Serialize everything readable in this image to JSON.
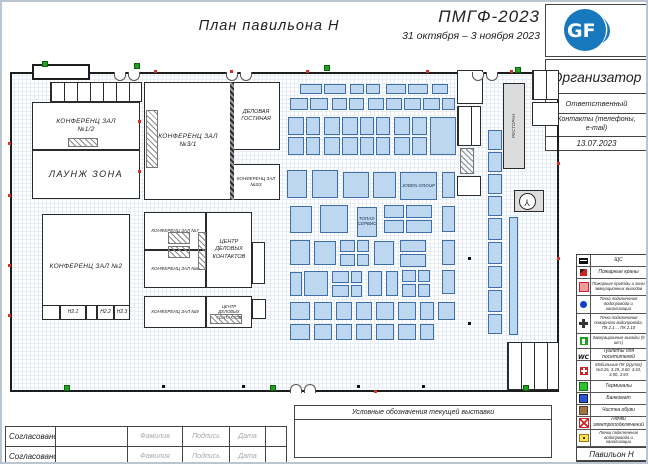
{
  "header": {
    "plan_title": "План павильона Н",
    "event_title": "ПМГФ-2023",
    "event_dates": "31 октября – 3 ноября 2023"
  },
  "logo": {
    "text": "GF",
    "color": "#1878be"
  },
  "org": {
    "organizer": "Организатор",
    "responsible": "Ответственный",
    "contacts": "Контакты (телефоны,\ne-mail)",
    "date": "13.07.2023"
  },
  "expo_box": {
    "title": "Условные обозначения текущей выставки"
  },
  "approval": {
    "rows": [
      {
        "label": "Согласовано",
        "surname": "Фамилия",
        "signature": "Подпись",
        "date": "Дата"
      },
      {
        "label": "Согласовано",
        "surname": "Фамилия",
        "signature": "Подпись",
        "date": "Дата"
      }
    ]
  },
  "legend": {
    "footer": "Павильон Н",
    "items": [
      {
        "icon": "panel",
        "h": 11,
        "label": "ЩС"
      },
      {
        "icon": "hydrant",
        "h": 11,
        "label": "Пожарные краны"
      },
      {
        "icon": "zone",
        "h": 16,
        "label": "Пожарные проезды и зоны эвакуационных выходов"
      },
      {
        "icon": "water",
        "h": 17,
        "label": "Точка подключения водопровода и канализации"
      },
      {
        "icon": "firewater",
        "h": 19,
        "label": "Точка подключения пожарного водопровода, ПК 2.1 ... ПК 2.10"
      },
      {
        "icon": "exit",
        "h": 14,
        "label": "Эвакуационные выходы (9 шт.)"
      },
      {
        "icon": "wc",
        "h": 11,
        "label": "Туалеты для посетителей"
      },
      {
        "icon": "mobilepk",
        "h": 19,
        "label": "Мобильные ПК (группа) №3.26, 3.29, 3.60, 3.63, 3.90, 3.93"
      },
      {
        "icon": "terminal",
        "h": 11,
        "label": "Терминалы"
      },
      {
        "icon": "atm",
        "h": 11,
        "label": "Банкомат"
      },
      {
        "icon": "shoe",
        "h": 11,
        "label": "Чистка обуви"
      },
      {
        "icon": "hatch-el",
        "h": 12,
        "label": "Лючки электроподключений"
      },
      {
        "icon": "hatch-wat",
        "h": 16,
        "label": "Лючки подключения водопровода и канализации"
      },
      {
        "icon": "air",
        "h": 14,
        "label": "Точки подключения сжатого воздуха"
      }
    ]
  },
  "plan": {
    "colors": {
      "booth_fill": "#bdd7f0",
      "booth_border": "#3f6fa5",
      "wall": "#1d1d1d",
      "exit_green": "#21a121",
      "fire_red": "#d43322",
      "logo_blue": "#1878be"
    },
    "rooms": [
      {
        "r": [
          8,
          70,
          549,
          320
        ],
        "label": "",
        "cls": "outer"
      },
      {
        "r": [
          30,
          62,
          58,
          16
        ],
        "label": "",
        "cls": "outer2"
      },
      {
        "r": [
          48,
          80,
          92,
          20
        ],
        "label": "",
        "cls": "cellsH"
      },
      {
        "r": [
          30,
          100,
          108,
          48
        ],
        "label": "КОНФЕРЕНЦ ЗАЛ\n№1/2",
        "cls": "lg"
      },
      {
        "r": [
          66,
          136,
          30,
          9
        ],
        "label": "",
        "cls": "hatch"
      },
      {
        "r": [
          30,
          148,
          108,
          49
        ],
        "label": "ЛАУНЖ ЗОНА",
        "cls": "xl"
      },
      {
        "r": [
          40,
          212,
          88,
          106
        ],
        "label": "КОНФЕРЕНЦ ЗАЛ №2",
        "cls": "lg"
      },
      {
        "r": [
          40,
          303,
          18,
          15
        ],
        "label": "",
        "cls": ""
      },
      {
        "r": [
          58,
          303,
          26,
          15
        ],
        "label": "Н2.1",
        "cls": "sm"
      },
      {
        "r": [
          84,
          303,
          11,
          15
        ],
        "label": "",
        "cls": ""
      },
      {
        "r": [
          95,
          303,
          17,
          15
        ],
        "label": "Н2.2",
        "cls": "sm"
      },
      {
        "r": [
          112,
          303,
          16,
          15
        ],
        "label": "Н2.3",
        "cls": "sm"
      },
      {
        "r": [
          142,
          80,
          88,
          118
        ],
        "label": "КОНФЕРЕНЦ ЗАЛ\n№3/1",
        "cls": "lg"
      },
      {
        "r": [
          144,
          108,
          12,
          58
        ],
        "label": "",
        "cls": "hatch"
      },
      {
        "r": [
          228,
          80,
          4,
          118
        ],
        "label": "",
        "cls": "wallT"
      },
      {
        "r": [
          230,
          80,
          48,
          68
        ],
        "label": "ДЕЛОВАЯ\nГОСТИНАЯ",
        "cls": "md"
      },
      {
        "r": [
          230,
          162,
          48,
          36
        ],
        "label": "КОНФЕРЕНЦ ЗАЛ\n№3/3",
        "cls": "xs"
      },
      {
        "r": [
          142,
          210,
          62,
          38
        ],
        "label": "КОНФЕРЕНЦ ЗАЛ №7",
        "cls": "xs"
      },
      {
        "r": [
          142,
          248,
          62,
          38
        ],
        "label": "КОНФЕРЕНЦ ЗАЛ №8",
        "cls": "xs"
      },
      {
        "r": [
          204,
          210,
          46,
          76
        ],
        "label": "ЦЕНТР\nДЕЛОВЫХ\nКОНТАКТОВ",
        "cls": "md"
      },
      {
        "r": [
          166,
          230,
          22,
          12
        ],
        "label": "",
        "cls": "hatch"
      },
      {
        "r": [
          166,
          244,
          22,
          12
        ],
        "label": "",
        "cls": "hatch"
      },
      {
        "r": [
          196,
          230,
          8,
          38
        ],
        "label": "",
        "cls": "hatch"
      },
      {
        "r": [
          250,
          240,
          13,
          42
        ],
        "label": "",
        "cls": ""
      },
      {
        "r": [
          142,
          294,
          62,
          32
        ],
        "label": "КОНФЕРЕНЦ ЗАЛ №9",
        "cls": "xs"
      },
      {
        "r": [
          204,
          294,
          46,
          32
        ],
        "label": "ЦЕНТР\nДЕЛОВЫХ\nКОНТАКТОВ",
        "cls": "xs2"
      },
      {
        "r": [
          208,
          312,
          32,
          10
        ],
        "label": "",
        "cls": "hatch"
      },
      {
        "r": [
          250,
          297,
          14,
          20
        ],
        "label": "",
        "cls": ""
      },
      {
        "r": [
          455,
          68,
          26,
          34
        ],
        "label": "",
        "cls": ""
      },
      {
        "r": [
          455,
          104,
          24,
          40
        ],
        "label": "",
        "cls": "cellsH"
      },
      {
        "r": [
          458,
          146,
          14,
          26
        ],
        "label": "",
        "cls": "hatch"
      },
      {
        "r": [
          455,
          174,
          24,
          20
        ],
        "label": "",
        "cls": ""
      },
      {
        "r": [
          501,
          81,
          22,
          86
        ],
        "label": "РЕСТОРАН",
        "cls": "grey vert"
      },
      {
        "r": [
          512,
          188,
          30,
          22
        ],
        "label": "",
        "cls": "grey"
      },
      {
        "r": [
          517,
          191,
          17,
          17
        ],
        "label": "Y",
        "cls": "fan"
      },
      {
        "r": [
          530,
          68,
          27,
          30
        ],
        "label": "",
        "cls": "cellsH"
      },
      {
        "r": [
          530,
          100,
          27,
          24
        ],
        "label": "",
        "cls": ""
      },
      {
        "r": [
          505,
          340,
          52,
          48
        ],
        "label": "",
        "cls": "cellsH"
      }
    ],
    "booths": [
      [
        298,
        82,
        22,
        10
      ],
      [
        322,
        82,
        22,
        10
      ],
      [
        348,
        82,
        14,
        10
      ],
      [
        364,
        82,
        14,
        10
      ],
      [
        384,
        82,
        20,
        10
      ],
      [
        406,
        82,
        20,
        10
      ],
      [
        430,
        82,
        16,
        10
      ],
      [
        288,
        96,
        18,
        12
      ],
      [
        308,
        96,
        18,
        12
      ],
      [
        330,
        96,
        15,
        12
      ],
      [
        347,
        96,
        15,
        12
      ],
      [
        366,
        96,
        16,
        12
      ],
      [
        384,
        96,
        16,
        12
      ],
      [
        402,
        96,
        17,
        12
      ],
      [
        421,
        96,
        17,
        12
      ],
      [
        440,
        96,
        13,
        12
      ],
      [
        286,
        115,
        16,
        18
      ],
      [
        304,
        115,
        14,
        18
      ],
      [
        322,
        115,
        16,
        18
      ],
      [
        340,
        115,
        16,
        18
      ],
      [
        358,
        115,
        14,
        18
      ],
      [
        374,
        115,
        14,
        18
      ],
      [
        392,
        115,
        16,
        18
      ],
      [
        410,
        115,
        15,
        18
      ],
      [
        428,
        115,
        26,
        38
      ],
      [
        286,
        135,
        16,
        18
      ],
      [
        304,
        135,
        14,
        18
      ],
      [
        322,
        135,
        16,
        18
      ],
      [
        340,
        135,
        16,
        18
      ],
      [
        358,
        135,
        14,
        18
      ],
      [
        374,
        135,
        14,
        18
      ],
      [
        392,
        135,
        16,
        18
      ],
      [
        410,
        135,
        15,
        18
      ],
      [
        285,
        168,
        20,
        28
      ],
      [
        310,
        168,
        26,
        28
      ],
      [
        341,
        170,
        26,
        26
      ],
      [
        371,
        170,
        23,
        26
      ],
      [
        398,
        170,
        37,
        28,
        "JODEN GROUP"
      ],
      [
        440,
        170,
        13,
        26
      ],
      [
        288,
        204,
        22,
        27
      ],
      [
        318,
        203,
        28,
        28
      ],
      [
        355,
        205,
        20,
        30,
        "ТОПАЗ-\nСЕРВИС"
      ],
      [
        382,
        203,
        20,
        13
      ],
      [
        404,
        203,
        26,
        13
      ],
      [
        382,
        218,
        20,
        13
      ],
      [
        404,
        218,
        26,
        13
      ],
      [
        440,
        204,
        13,
        26
      ],
      [
        288,
        238,
        20,
        25
      ],
      [
        312,
        239,
        22,
        24
      ],
      [
        338,
        238,
        15,
        12
      ],
      [
        355,
        238,
        12,
        12
      ],
      [
        338,
        252,
        15,
        12
      ],
      [
        355,
        252,
        12,
        12
      ],
      [
        372,
        239,
        20,
        24
      ],
      [
        398,
        238,
        26,
        12
      ],
      [
        398,
        252,
        26,
        13
      ],
      [
        440,
        238,
        13,
        25
      ],
      [
        288,
        270,
        12,
        24
      ],
      [
        302,
        269,
        24,
        25
      ],
      [
        330,
        269,
        17,
        12
      ],
      [
        349,
        269,
        11,
        12
      ],
      [
        330,
        283,
        17,
        12
      ],
      [
        349,
        283,
        11,
        12
      ],
      [
        366,
        269,
        14,
        25
      ],
      [
        384,
        269,
        12,
        25
      ],
      [
        400,
        268,
        14,
        12
      ],
      [
        416,
        268,
        12,
        12
      ],
      [
        400,
        282,
        14,
        13
      ],
      [
        416,
        282,
        12,
        13
      ],
      [
        440,
        268,
        13,
        24
      ],
      [
        288,
        300,
        20,
        18
      ],
      [
        312,
        300,
        18,
        18
      ],
      [
        334,
        300,
        16,
        18
      ],
      [
        354,
        300,
        16,
        18
      ],
      [
        374,
        300,
        18,
        18
      ],
      [
        396,
        300,
        18,
        18
      ],
      [
        418,
        300,
        14,
        18
      ],
      [
        436,
        300,
        17,
        18
      ],
      [
        288,
        322,
        20,
        16
      ],
      [
        312,
        322,
        18,
        16
      ],
      [
        334,
        322,
        16,
        16
      ],
      [
        354,
        322,
        16,
        16
      ],
      [
        374,
        322,
        18,
        16
      ],
      [
        396,
        322,
        18,
        16
      ],
      [
        418,
        322,
        14,
        16
      ],
      [
        486,
        128,
        14,
        20
      ],
      [
        486,
        150,
        14,
        20
      ],
      [
        486,
        172,
        14,
        20
      ],
      [
        486,
        194,
        14,
        20
      ],
      [
        486,
        216,
        14,
        22
      ],
      [
        486,
        240,
        14,
        22
      ],
      [
        486,
        264,
        14,
        22
      ],
      [
        486,
        288,
        14,
        22
      ],
      [
        486,
        312,
        14,
        20
      ],
      [
        507,
        215,
        9,
        118
      ]
    ],
    "doors": [
      [
        112,
        70,
        0
      ],
      [
        224,
        70,
        0
      ],
      [
        470,
        70,
        0
      ],
      [
        288,
        382,
        1
      ]
    ],
    "exits": [
      [
        40,
        59
      ],
      [
        132,
        61
      ],
      [
        322,
        63
      ],
      [
        513,
        65
      ],
      [
        62,
        383
      ],
      [
        268,
        383
      ],
      [
        521,
        383
      ]
    ],
    "fire_marks": [
      [
        152,
        68
      ],
      [
        228,
        68
      ],
      [
        304,
        68
      ],
      [
        424,
        68
      ],
      [
        508,
        68
      ],
      [
        6,
        140
      ],
      [
        6,
        192
      ],
      [
        6,
        262
      ],
      [
        6,
        312
      ],
      [
        136,
        118
      ],
      [
        136,
        168
      ],
      [
        555,
        160
      ],
      [
        555,
        255
      ],
      [
        372,
        388
      ]
    ],
    "dots": [
      [
        160,
        383
      ],
      [
        240,
        383
      ],
      [
        355,
        383
      ],
      [
        420,
        383
      ],
      [
        466,
        255
      ],
      [
        466,
        320
      ]
    ]
  }
}
